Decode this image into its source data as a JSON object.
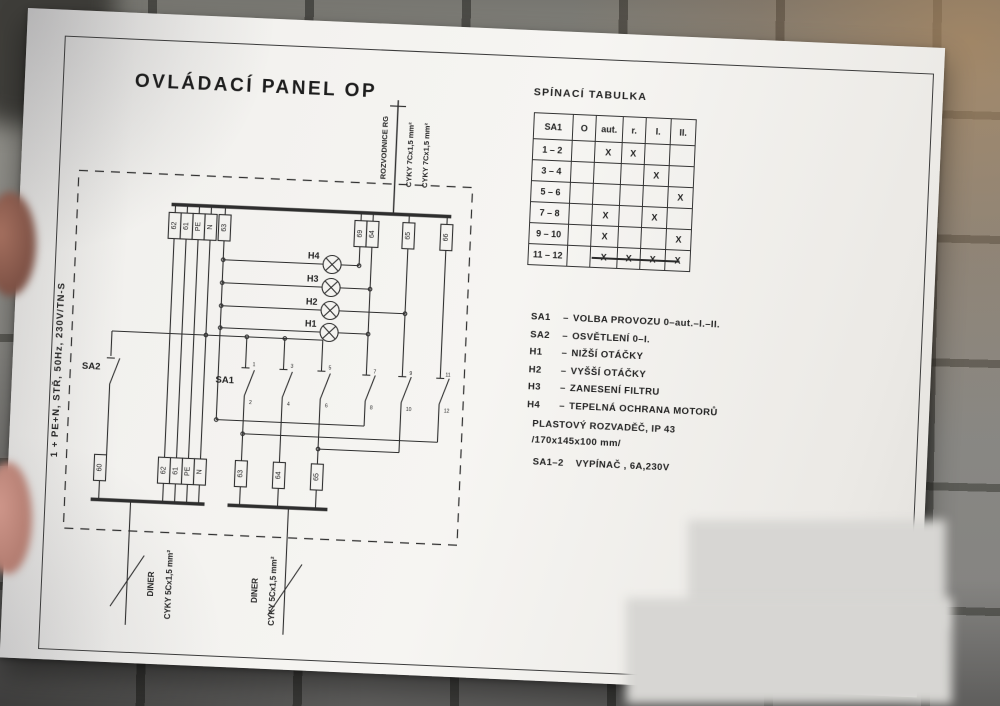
{
  "title": "OVLÁDACÍ PANEL OP",
  "switch_table": {
    "title": "SPÍNACÍ TABULKA",
    "headers": [
      "SA1",
      "O",
      "aut.",
      "r.",
      "I.",
      "II."
    ],
    "rows": [
      {
        "label": "1 – 2",
        "marks": [
          "",
          "X",
          "X",
          "",
          ""
        ]
      },
      {
        "label": "3 – 4",
        "marks": [
          "",
          "",
          "",
          "X",
          ""
        ]
      },
      {
        "label": "5 – 6",
        "marks": [
          "",
          "",
          "",
          "",
          "X"
        ]
      },
      {
        "label": "7 – 8",
        "marks": [
          "",
          "X",
          "",
          "X",
          ""
        ]
      },
      {
        "label": "9 – 10",
        "marks": [
          "",
          "X",
          "",
          "",
          "X"
        ]
      },
      {
        "label": "11 – 12",
        "marks": [
          "",
          "X",
          "X",
          "X",
          "X"
        ]
      }
    ]
  },
  "legend": {
    "items": [
      {
        "key": "SA1",
        "sep": "–",
        "desc": "VOLBA PROVOZU  0–aut.–I.–II."
      },
      {
        "key": "SA2",
        "sep": "–",
        "desc": "OSVĚTLENÍ 0–I."
      },
      {
        "key": "H1",
        "sep": "–",
        "desc": "NIŽŠÍ OTÁČKY"
      },
      {
        "key": "H2",
        "sep": "–",
        "desc": "VYŠŠÍ OTÁČKY"
      },
      {
        "key": "H3",
        "sep": "–",
        "desc": "ZANESENÍ FILTRU"
      },
      {
        "key": "H4",
        "sep": "–",
        "desc": "TEPELNÁ OCHRANA MOTORŮ"
      }
    ]
  },
  "notes": {
    "enclosure_line1": "PLASTOVÝ ROZVADĚČ, IP 43",
    "enclosure_line2": "/170x145x100 mm/",
    "switch_key": "SA1–2",
    "switch_desc": "VYPÍNAČ , 6A,230V"
  },
  "schematic": {
    "supply_label": "1 + PE+N, STŘ, 50Hz, 230V/TN-S",
    "rozvodnice_label": "ROZVODNICE RG",
    "top_cable_1": "CYKY 7Cx1,5 mm²",
    "top_cable_2": "CYKY 7Cx1,5 mm²",
    "sa1_label": "SA1",
    "sa2_label": "SA2",
    "lamps": {
      "h4": "H4",
      "h3": "H3",
      "h2": "H2",
      "h1": "H1"
    },
    "top_terminals_left": [
      "62",
      "61",
      "PE",
      "N",
      "63"
    ],
    "top_terminals_right": [
      "69",
      "64",
      "65",
      "66"
    ],
    "bottom_terminals_left": [
      "60",
      "62",
      "61",
      "PE",
      "N"
    ],
    "bottom_terminals_right": [
      "63",
      "64",
      "65"
    ],
    "sa1_contact_top_numbers": [
      "1",
      "3",
      "5",
      "7",
      "9",
      "11"
    ],
    "sa1_contact_bottom_numbers": [
      "2",
      "4",
      "6",
      "8",
      "10",
      "12"
    ],
    "bottom_cable_1": {
      "name": "DINER",
      "spec": "CYKY 5Cx1,5 mm²"
    },
    "bottom_cable_2": {
      "name": "DINER",
      "spec": "CYKY 5Cx1,5 mm²"
    }
  }
}
